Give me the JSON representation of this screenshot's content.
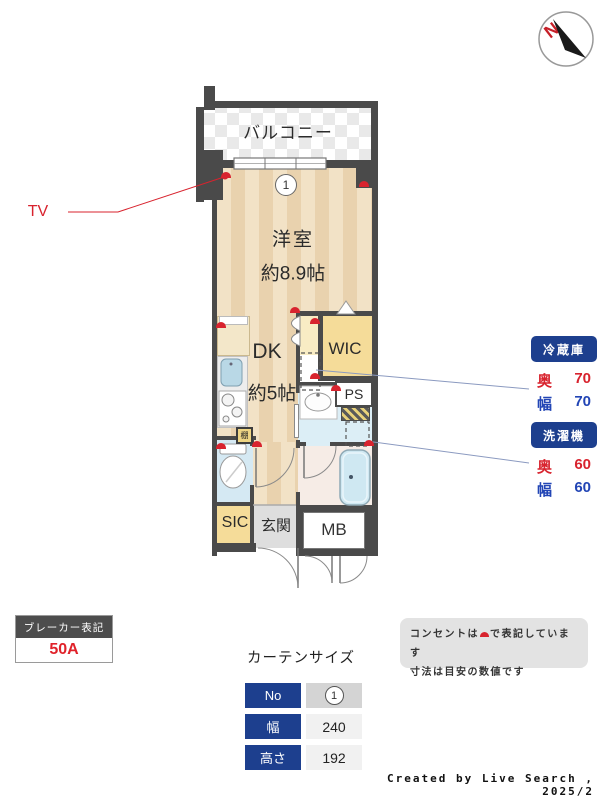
{
  "compass": {
    "north": "N"
  },
  "plan": {
    "balcony": "バルコニー",
    "window_no": "1",
    "room_main": {
      "name": "洋室",
      "size": "約8.9帖"
    },
    "dk": {
      "name": "DK",
      "size": "約5帖"
    },
    "wic": "WIC",
    "ps": "PS",
    "sic": "SIC",
    "entrance": "玄関",
    "mb": "MB",
    "shelf": "棚",
    "tv": "TV"
  },
  "appliances": {
    "fridge": {
      "title": "冷蔵庫",
      "depth_label": "奥",
      "depth": "70",
      "width_label": "幅",
      "width": "70"
    },
    "washer": {
      "title": "洗濯機",
      "depth_label": "奥",
      "depth": "60",
      "width_label": "幅",
      "width": "60"
    }
  },
  "breaker": {
    "title": "ブレーカー表記",
    "value": "50A"
  },
  "curtain": {
    "title": "カーテンサイズ",
    "rows": [
      {
        "label": "No",
        "value": "1"
      },
      {
        "label": "幅",
        "value": "240"
      },
      {
        "label": "高さ",
        "value": "192"
      }
    ]
  },
  "note": {
    "line1_pre": "コンセントは",
    "line1_post": "で表記しています",
    "line2": "寸法は目安の数値です"
  },
  "credit": "Created by Live Search , 2025/2",
  "colors": {
    "wall": "#4a4a4a",
    "accent_red": "#d8232e",
    "accent_blue": "#2245b5",
    "navy": "#1d3f8e",
    "closet_yellow": "#f5dc99"
  }
}
